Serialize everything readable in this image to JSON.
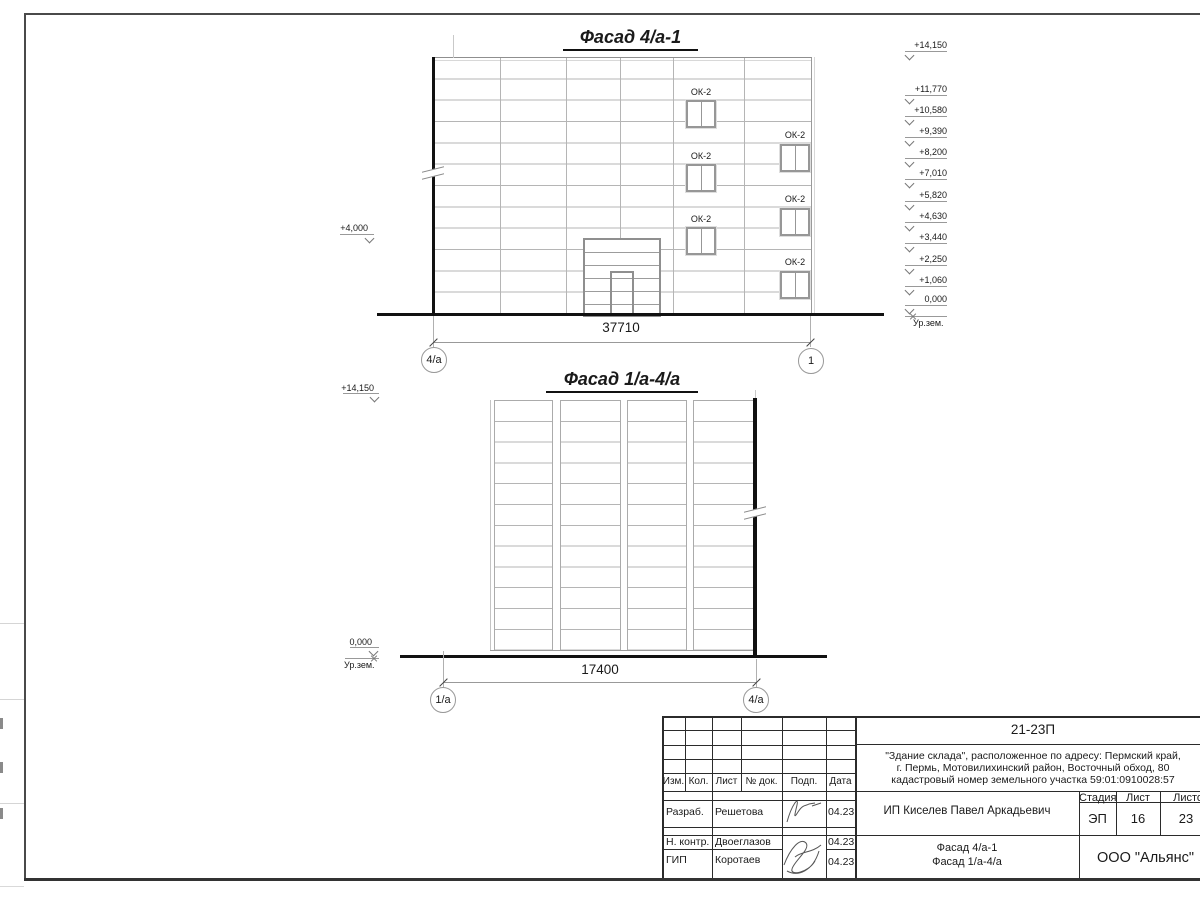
{
  "top_facade": {
    "title": "Фасад 4/а-1",
    "dimension": "37710",
    "axis_left": "4/а",
    "axis_right": "1",
    "left_mark": "+4,000",
    "window_label": "ОК-2",
    "elevation_marks": [
      {
        "label": "+14,150",
        "y": 51
      },
      {
        "label": "+11,770",
        "y": 95
      },
      {
        "label": "+10,580",
        "y": 116
      },
      {
        "label": "+9,390",
        "y": 137
      },
      {
        "label": "+8,200",
        "y": 158
      },
      {
        "label": "+7,010",
        "y": 179
      },
      {
        "label": "+5,820",
        "y": 201
      },
      {
        "label": "+4,630",
        "y": 222
      },
      {
        "label": "+3,440",
        "y": 243
      },
      {
        "label": "+2,250",
        "y": 265
      },
      {
        "label": "+1,060",
        "y": 286
      },
      {
        "label": "0,000",
        "y": 305
      }
    ],
    "ground_mark": "Ур.зем."
  },
  "bottom_facade": {
    "title": "Фасад 1/а-4/а",
    "dimension": "17400",
    "axis_left": "1/а",
    "axis_right": "4/а",
    "mark_top": "+14,150",
    "mark_zero": "0,000",
    "mark_ground": "Ур.зем."
  },
  "title_block": {
    "code": "21-23П",
    "address_line1": "\"Здание склада\", расположенное по адресу: Пермский край,",
    "address_line2": "г. Пермь, Мотовилихинский район, Восточный обход, 80",
    "address_line3": "кадастровый номер земельного участка 59:01:0910028:57",
    "col_izm": "Изм.",
    "col_kol": "Кол.",
    "col_list": "Лист",
    "col_ndok": "№ док.",
    "col_podp": "Подп.",
    "col_data": "Дата",
    "row1_role": "Разраб.",
    "row1_name": "Решетова",
    "row1_date": "04.23",
    "row2_role": "Н. контр.",
    "row2_name": "Двоеглазов",
    "row2_date": "04.23",
    "row3_role": "ГИП",
    "row3_name": "Коротаев",
    "row3_date": "04.23",
    "client": "ИП Киселев Павел Аркадьевич",
    "stage_label": "Стадия",
    "sheet_label": "Лист",
    "sheets_label": "Листов",
    "stage_value": "ЭП",
    "sheet_value": "16",
    "sheets_value": "23",
    "doc_title_line1": "Фасад 4/а-1",
    "doc_title_line2": "Фасад 1/а-4/а",
    "company": "ООО \"Альянс\""
  }
}
